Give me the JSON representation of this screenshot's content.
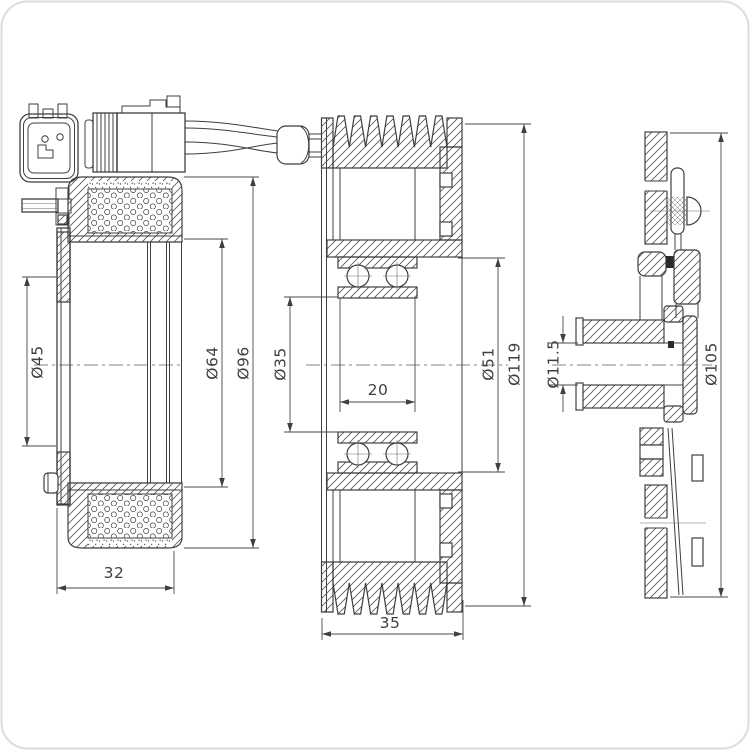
{
  "drawing": {
    "kind": "technical drawing of A/C compressor clutch kit (coil, pulley, clutch plate)",
    "colors": {
      "background": "#ffffff",
      "line": "#3f3f3f",
      "frame": "#dcdcdc"
    },
    "views": {
      "coil": {
        "name": "electromagnetic coil side section",
        "dims": {
          "flange_inner_diameter": "Ø45",
          "core_diameter": "Ø64",
          "outer_diameter": "Ø96",
          "depth": "32"
        }
      },
      "pulley": {
        "name": "pulley cross section with bearing",
        "dims": {
          "bearing_bore_diameter": "Ø35",
          "bearing_width": "20",
          "bearing_seat_diameter": "Ø51",
          "outer_diameter": "Ø119",
          "width": "35"
        }
      },
      "hub": {
        "name": "clutch plate side section",
        "dims": {
          "bore_diameter": "Ø11.5",
          "plate_diameter": "Ø105"
        }
      }
    }
  }
}
